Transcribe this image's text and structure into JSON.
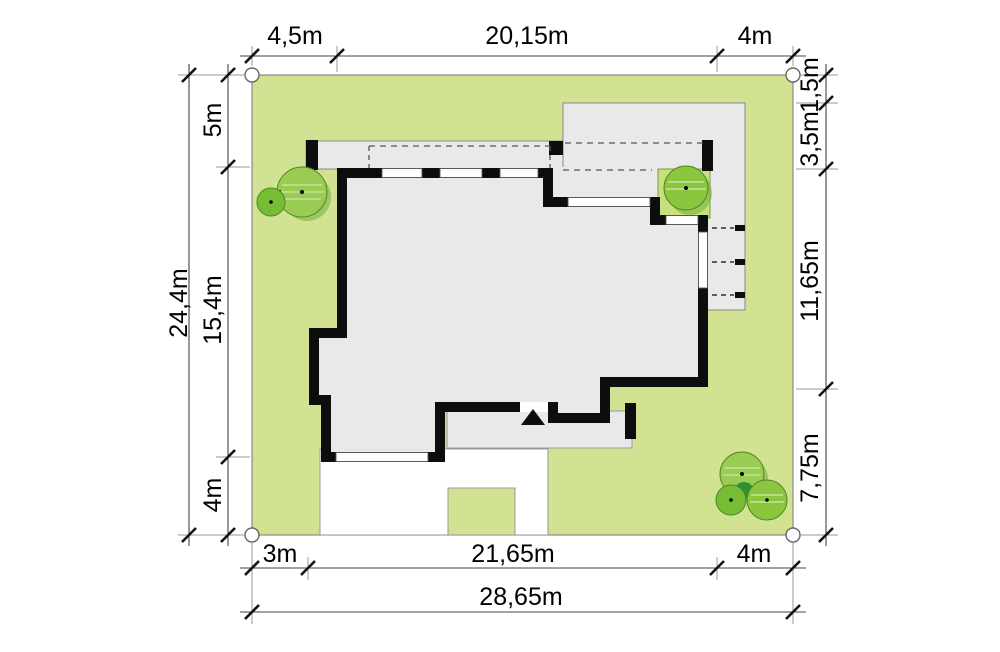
{
  "plan": {
    "type": "architectural-site-plan",
    "dims": {
      "top": [
        "4,5m",
        "20,15m",
        "4m"
      ],
      "left": [
        "24,4m",
        "5m",
        "15,4m",
        "4m"
      ],
      "right": [
        "1,5m",
        "3,5m",
        "11,65m",
        "7,75m"
      ],
      "bottom": [
        "3m",
        "21,65m",
        "4m",
        "28,65m"
      ]
    },
    "colors": {
      "plot_green": "#d2e293",
      "patio_green": "#c6e07c",
      "building_gray": "#e9e9e9",
      "wall_black": "#0d0d0d",
      "paving_white": "#ffffff",
      "tree_light": "#9acb52",
      "tree_mid": "#8cc63f",
      "tree_dark": "#76bd35",
      "tree_accent": "#2f9134",
      "dim_line": "#444444"
    }
  }
}
